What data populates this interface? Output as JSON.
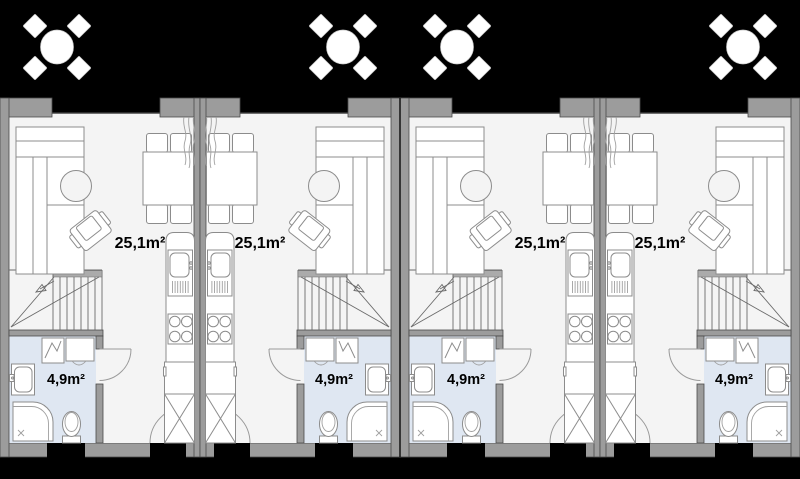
{
  "plan": {
    "type": "architectural-floor-plan",
    "building": "row of four terraced housing units, ground floor",
    "colors": {
      "outside": "#000000",
      "wall": "#9c9c9c",
      "floor": "#f4f4f4",
      "bathroom": "#dfe7f2",
      "furniture_outline": "#8c8c8c"
    },
    "units": [
      {
        "name": "unit-1",
        "mirrored": false,
        "living_area_label": "25,1m²",
        "bathroom_area_label": "4,9m²"
      },
      {
        "name": "unit-2",
        "mirrored": true,
        "living_area_label": "25,1m²",
        "bathroom_area_label": "4,9m²"
      },
      {
        "name": "unit-3",
        "mirrored": false,
        "living_area_label": "25,1m²",
        "bathroom_area_label": "4,9m²"
      },
      {
        "name": "unit-4",
        "mirrored": true,
        "living_area_label": "25,1m²",
        "bathroom_area_label": "4,9m²"
      }
    ]
  }
}
